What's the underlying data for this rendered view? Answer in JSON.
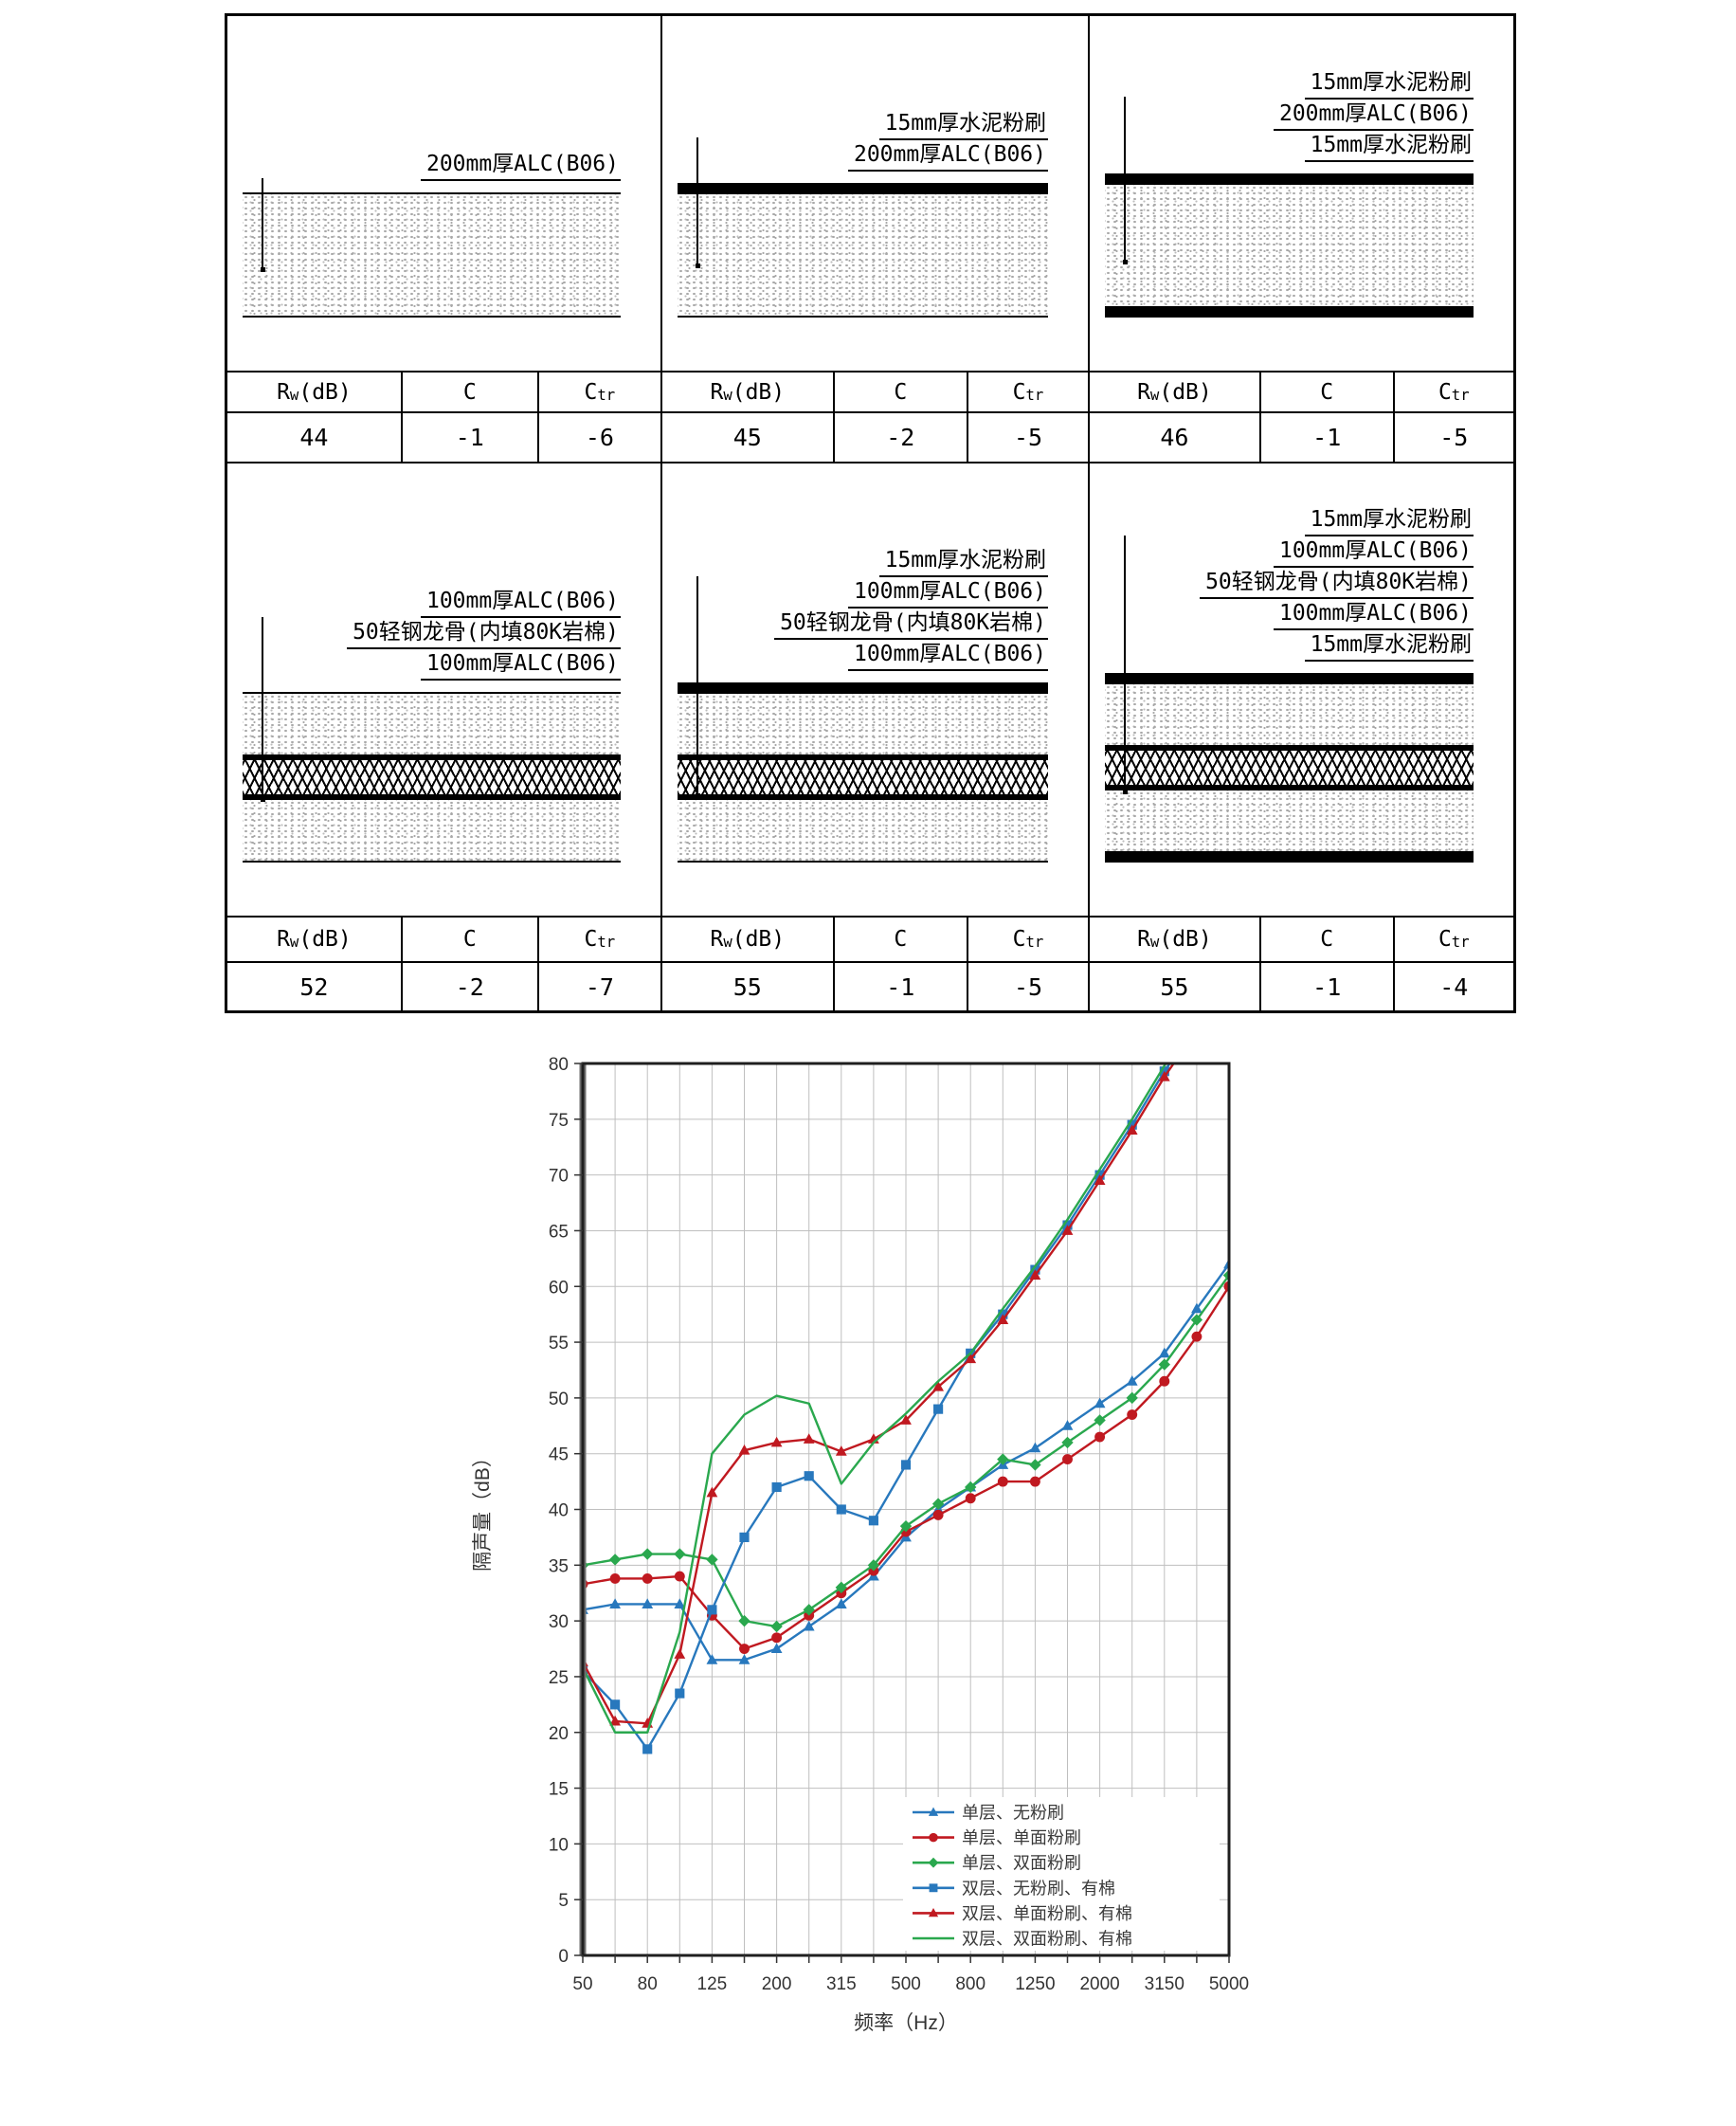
{
  "table": {
    "header": {
      "rw_r": "R",
      "rw_sub": "w",
      "rw_unit": "(dB)",
      "c": "C",
      "ctr_c": "C",
      "ctr_sub": "tr"
    },
    "cells": [
      {
        "layers": [
          {
            "label": "200mm厚ALC(B06)",
            "type": "alc",
            "mm": 200
          }
        ],
        "rw": "44",
        "c": "-1",
        "ctr": "-6"
      },
      {
        "layers": [
          {
            "label": "15mm厚水泥粉刷",
            "type": "plaster",
            "mm": 15
          },
          {
            "label": "200mm厚ALC(B06)",
            "type": "alc",
            "mm": 200
          }
        ],
        "rw": "45",
        "c": "-2",
        "ctr": "-5"
      },
      {
        "layers": [
          {
            "label": "15mm厚水泥粉刷",
            "type": "plaster",
            "mm": 15
          },
          {
            "label": "200mm厚ALC(B06)",
            "type": "alc",
            "mm": 200
          },
          {
            "label": "15mm厚水泥粉刷",
            "type": "plaster",
            "mm": 15
          }
        ],
        "rw": "46",
        "c": "-1",
        "ctr": "-5"
      },
      {
        "layers": [
          {
            "label": "100mm厚ALC(B06)",
            "type": "alc",
            "mm": 100
          },
          {
            "label": "50轻钢龙骨(内填80K岩棉)",
            "type": "wool",
            "mm": 50
          },
          {
            "label": "100mm厚ALC(B06)",
            "type": "alc",
            "mm": 100
          }
        ],
        "rw": "52",
        "c": "-2",
        "ctr": "-7"
      },
      {
        "layers": [
          {
            "label": "15mm厚水泥粉刷",
            "type": "plaster",
            "mm": 15
          },
          {
            "label": "100mm厚ALC(B06)",
            "type": "alc",
            "mm": 100
          },
          {
            "label": "50轻钢龙骨(内填80K岩棉)",
            "type": "wool",
            "mm": 50
          },
          {
            "label": "100mm厚ALC(B06)",
            "type": "alc",
            "mm": 100
          }
        ],
        "rw": "55",
        "c": "-1",
        "ctr": "-5"
      },
      {
        "layers": [
          {
            "label": "15mm厚水泥粉刷",
            "type": "plaster",
            "mm": 15
          },
          {
            "label": "100mm厚ALC(B06)",
            "type": "alc",
            "mm": 100
          },
          {
            "label": "50轻钢龙骨(内填80K岩棉)",
            "type": "wool",
            "mm": 50
          },
          {
            "label": "100mm厚ALC(B06)",
            "type": "alc",
            "mm": 100
          },
          {
            "label": "15mm厚水泥粉刷",
            "type": "plaster",
            "mm": 15
          }
        ],
        "rw": "55",
        "c": "-1",
        "ctr": "-4"
      }
    ]
  },
  "chart_data": {
    "type": "line",
    "xlabel": "频率（Hz）",
    "ylabel": "隔声量（dB）",
    "ylim": [
      0,
      80
    ],
    "y_step": 5,
    "grid": true,
    "legend_position": "lower-right",
    "x_categories": [
      50,
      63,
      80,
      100,
      125,
      160,
      200,
      250,
      315,
      400,
      500,
      630,
      800,
      1000,
      1250,
      1600,
      2000,
      2500,
      3150,
      4000,
      5000
    ],
    "x_tick_labels": [
      "50",
      "80",
      "125",
      "200",
      "315",
      "500",
      "800",
      "1250",
      "2000",
      "3150",
      "5000"
    ],
    "series": [
      {
        "name": "单层、无粉刷",
        "color": "#2878bd",
        "marker": "triangle",
        "values": [
          31,
          31.5,
          31.5,
          31.5,
          26.5,
          26.5,
          27.5,
          29.5,
          31.5,
          34,
          37.5,
          40,
          42,
          44,
          45.5,
          47.5,
          49.5,
          51.5,
          54,
          58,
          62
        ]
      },
      {
        "name": "单层、单面粉刷",
        "color": "#c01920",
        "marker": "circle",
        "values": [
          33.3,
          33.8,
          33.8,
          34,
          30.5,
          27.5,
          28.5,
          30.5,
          32.5,
          34.5,
          38,
          39.5,
          41,
          42.5,
          42.5,
          44.5,
          46.5,
          48.5,
          51.5,
          55.5,
          60
        ]
      },
      {
        "name": "单层、双面粉刷",
        "color": "#2aa84e",
        "marker": "diamond",
        "values": [
          35,
          35.5,
          36,
          36,
          35.5,
          30,
          29.5,
          31,
          33,
          35,
          38.5,
          40.5,
          42,
          44.5,
          44,
          46,
          48,
          50,
          53,
          57,
          61
        ]
      },
      {
        "name": "双层、无粉刷、有棉",
        "color": "#2878bd",
        "marker": "square",
        "values": [
          25.5,
          22.5,
          18.5,
          23.5,
          31,
          37.5,
          42,
          43,
          40,
          39,
          44,
          49,
          54,
          57.5,
          61.5,
          65.5,
          70,
          74.5,
          79.3,
          83.5,
          null
        ]
      },
      {
        "name": "双层、单面粉刷、有棉",
        "color": "#c01920",
        "marker": "triangle",
        "values": [
          26.3,
          21,
          20.8,
          27,
          41.5,
          45.3,
          46,
          46.3,
          45.2,
          46.3,
          48,
          51,
          53.5,
          57,
          61,
          65,
          69.5,
          74,
          78.8,
          83,
          null
        ]
      },
      {
        "name": "双层、双面粉刷、有棉",
        "color": "#2aa84e",
        "marker": "none",
        "values": [
          25.8,
          20,
          20,
          29,
          45,
          48.5,
          50.2,
          49.5,
          42.3,
          46,
          48.6,
          51.5,
          54,
          58,
          61.8,
          66,
          70.5,
          75,
          79.8,
          84,
          null
        ]
      }
    ]
  }
}
